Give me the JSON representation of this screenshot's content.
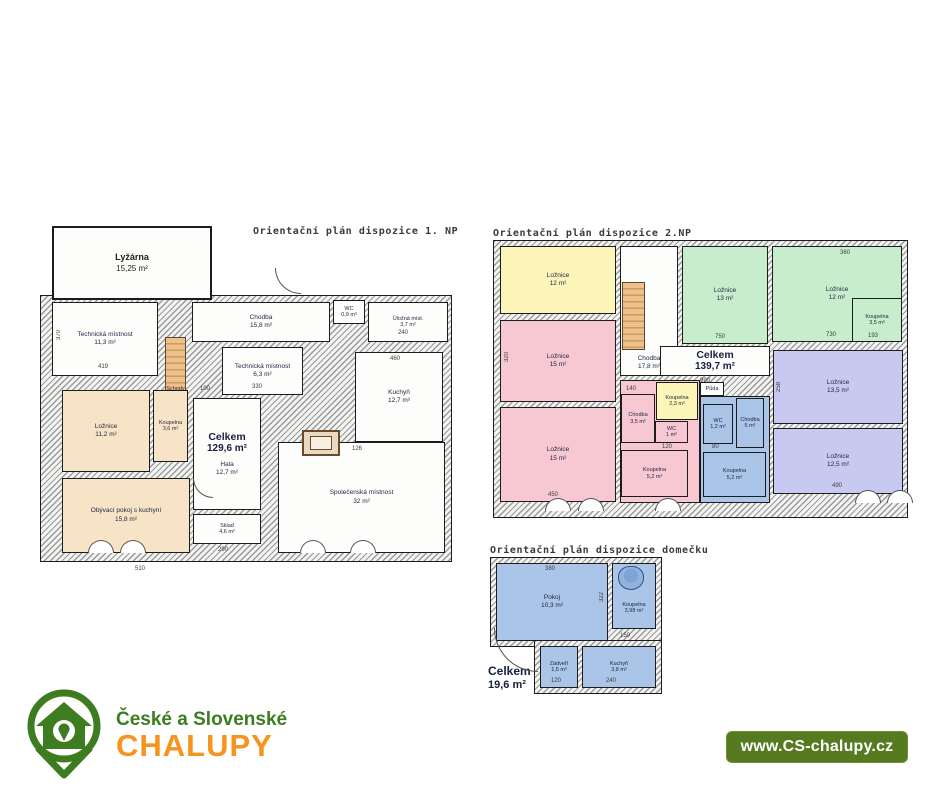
{
  "plans": [
    {
      "title": "Orientační plán dispozice 1. NP",
      "total": {
        "label": "Celkem",
        "area": "129,6 m²"
      },
      "rooms": [
        {
          "name": "Lyžárna",
          "area": "15,25 m²"
        },
        {
          "name": "Technická místnost",
          "area": "11,3 m²"
        },
        {
          "name": "Chodba",
          "area": "15,8 m²"
        },
        {
          "name": "WC",
          "area": "0,9 m²"
        },
        {
          "name": "Úložná míst.",
          "area": "3,7 m²"
        },
        {
          "name": "Technická místnost",
          "area": "6,3 m²"
        },
        {
          "name": "Kuchyň",
          "area": "12,7 m²"
        },
        {
          "name": "Schody",
          "area": ""
        },
        {
          "name": "Ložnice",
          "area": "11,2 m²"
        },
        {
          "name": "Koupelna",
          "area": "3,6 m²"
        },
        {
          "name": "Obývací pokoj s kuchyní",
          "area": "15,8 m²"
        },
        {
          "name": "Hala",
          "area": "12,7 m²"
        },
        {
          "name": "Sklad",
          "area": "4,6 m²"
        },
        {
          "name": "Společenská místnost",
          "area": "32 m²"
        }
      ],
      "dims": [
        "370",
        "419",
        "510",
        "330",
        "460",
        "126",
        "240",
        "290",
        "100"
      ]
    },
    {
      "title": "Orientační plán dispozice 2.NP",
      "total": {
        "label": "Celkem",
        "area": "139,7 m²"
      },
      "rooms": [
        {
          "name": "Ložnice",
          "area": "12 m²"
        },
        {
          "name": "Ložnice",
          "area": "15 m²"
        },
        {
          "name": "Ložnice",
          "area": "15 m²"
        },
        {
          "name": "Chodba",
          "area": "17,8 m²"
        },
        {
          "name": "Ložnice",
          "area": "13 m²"
        },
        {
          "name": "Ložnice",
          "area": "12 m²"
        },
        {
          "name": "Koupelna",
          "area": "3,5 m²"
        },
        {
          "name": "Ložnice",
          "area": "13,5 m²"
        },
        {
          "name": "Ložnice",
          "area": "12,5 m²"
        },
        {
          "name": "Chodba",
          "area": "3,5 m²"
        },
        {
          "name": "WC",
          "area": "1 m²"
        },
        {
          "name": "Koupelna",
          "area": "5,2 m²"
        },
        {
          "name": "Koupelna",
          "area": "2,3 m²"
        },
        {
          "name": "Půda",
          "area": ""
        },
        {
          "name": "WC",
          "area": "1,2 m²"
        },
        {
          "name": "Chodba",
          "area": "5 m²"
        },
        {
          "name": "Koupelna",
          "area": "5,2 m²"
        }
      ],
      "dims": [
        "320",
        "450",
        "750",
        "730",
        "990",
        "490",
        "140",
        "120",
        "80",
        "258",
        "360",
        "193"
      ]
    },
    {
      "title": "Orientační plán dispozice domečku",
      "total": {
        "label": "Celkem",
        "area": "19,6 m²"
      },
      "rooms": [
        {
          "name": "Pokoj",
          "area": "10,3 m²"
        },
        {
          "name": "Koupelna",
          "area": "3,98 m²"
        },
        {
          "name": "Zádveří",
          "area": "1,5 m²"
        },
        {
          "name": "Kuchyň",
          "area": "3,8 m²"
        }
      ],
      "dims": [
        "380",
        "322",
        "150",
        "120",
        "240"
      ]
    }
  ],
  "logo": {
    "line1": "České a Slovenské",
    "line2": "CHALUPY",
    "green": "#3e7c20",
    "orange": "#f7941e"
  },
  "badge": {
    "text": "www.CS-chalupy.cz",
    "background": "#567a1f"
  },
  "colors": {
    "floor1_rooms": "#f7e4c6",
    "stairs": "#cf9a5c",
    "floor2_yellow": "#fcf5b8",
    "floor2_pink": "#f8c8d2",
    "floor2_green": "#c8edcc",
    "floor2_purple": "#c8c9f0",
    "cottage_blue": "#abc5e8",
    "wall_hatch": "#9a9a9a"
  }
}
